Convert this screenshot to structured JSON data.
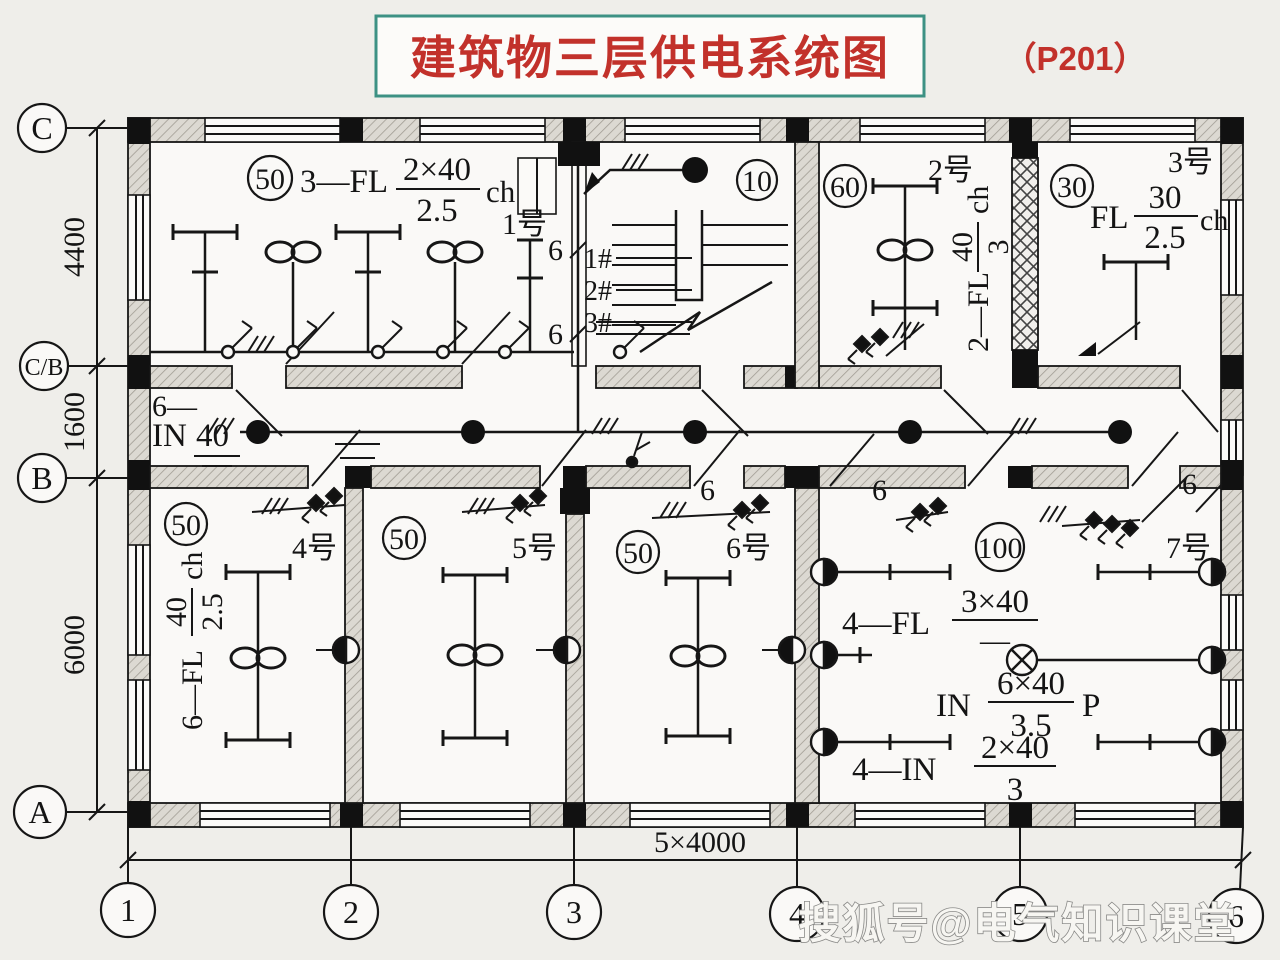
{
  "title": {
    "text": "建筑物三层供电系统图",
    "page_ref": "（P201）"
  },
  "watermark": "搜狐号@电气知识课堂",
  "grid": {
    "row_labels": [
      "C",
      "C/B",
      "B",
      "A"
    ],
    "col_labels": [
      "1",
      "2",
      "3",
      "4",
      "5",
      "6"
    ],
    "v_dims": [
      "4400",
      "1600",
      "6000"
    ],
    "h_dim": "5×4000"
  },
  "wire_count": "6",
  "corridor": {
    "prefix": "6—",
    "name": "IN",
    "num": "40"
  },
  "rooms": {
    "room1": {
      "rating": "50",
      "number": "1号",
      "circuit": {
        "prefix": "3—FL",
        "num": "2×40",
        "den": "2.5",
        "unit": "ch"
      }
    },
    "stair": {
      "rating": "10",
      "risers": [
        "1#",
        "2#",
        "3#"
      ]
    },
    "room2": {
      "rating": "60",
      "number": "2号",
      "circuit": {
        "prefix": "2—FL",
        "num": "40",
        "den": "3",
        "unit": "ch"
      }
    },
    "room3": {
      "rating": "30",
      "number": "3号",
      "circuit": {
        "prefix": "FL",
        "num": "30",
        "den": "2.5",
        "unit": "ch"
      }
    },
    "room4": {
      "rating": "50",
      "number": "4号",
      "circuit": {
        "prefix": "6—FL",
        "num": "40",
        "den": "2.5",
        "unit": "ch"
      }
    },
    "room5": {
      "rating": "50",
      "number": "5号"
    },
    "room6": {
      "rating": "50",
      "number": "6号"
    },
    "room7": {
      "rating": "100",
      "number": "7号",
      "circuits": [
        {
          "prefix": "4—FL",
          "num": "3×40",
          "den": "—"
        },
        {
          "prefix": "IN",
          "num": "6×40",
          "den": "3.5",
          "unit": "P"
        },
        {
          "prefix": "4—IN",
          "num": "2×40",
          "den": "3"
        }
      ]
    }
  }
}
